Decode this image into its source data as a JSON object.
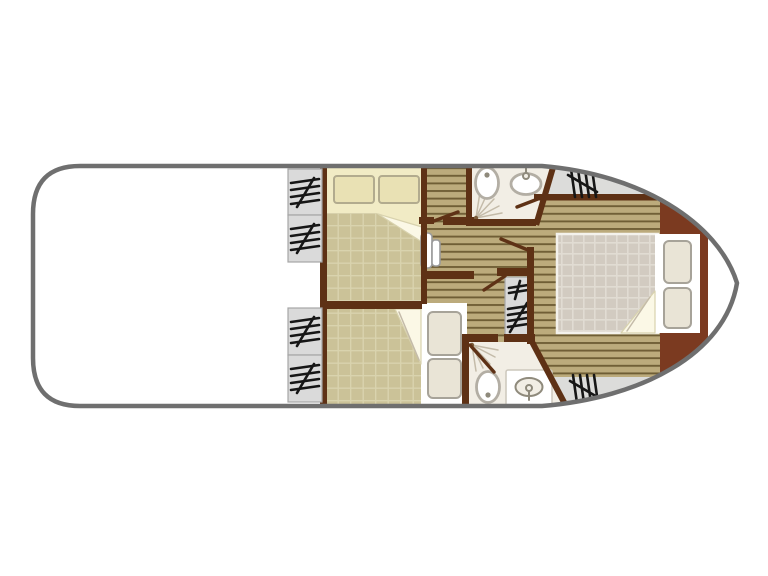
{
  "diagram": {
    "type": "boat-deck-plan",
    "description": "Top-down floor plan of a canal cruiser hull: open rounded aft deck on the left, two guest cabins with berths amidships, two shower rooms with WC and washbasin, a central companionway with steps, and a bow double-berth cabin; bow points to the right.",
    "orientation": "bow-right"
  },
  "rooms": [
    {
      "name": "aft-deck",
      "kind": "open deck",
      "furniture": []
    },
    {
      "name": "guest-cabin-port",
      "kind": "cabin",
      "furniture": [
        "double berth",
        "two pillows",
        "folded blanket"
      ]
    },
    {
      "name": "guest-cabin-starboard",
      "kind": "cabin",
      "furniture": [
        "berth",
        "two pillows",
        "folded blanket"
      ]
    },
    {
      "name": "shower-room-port",
      "kind": "bathroom",
      "furniture": [
        "toilet",
        "washbasin with tap",
        "corner shower spray"
      ]
    },
    {
      "name": "shower-room-starboard",
      "kind": "bathroom",
      "furniture": [
        "toilet",
        "washbasin counter with tap",
        "corner shower spray"
      ]
    },
    {
      "name": "companionway",
      "kind": "corridor",
      "furniture": [
        "steps",
        "fold-down seat"
      ]
    },
    {
      "name": "master-cabin-bow",
      "kind": "cabin",
      "furniture": [
        "double berth with quilted cover",
        "two pillows",
        "folded sheet",
        "hull-side locker"
      ]
    }
  ],
  "symbols": {
    "stair_marks": [
      {
        "location": "aft bulkhead upper",
        "count": 2
      },
      {
        "location": "aft bulkhead lower",
        "count": 2
      },
      {
        "location": "companionway",
        "count": 2
      },
      {
        "location": "bow side deck upper",
        "count": 1
      },
      {
        "location": "bow side deck lower",
        "count": 1
      }
    ]
  },
  "colors": {
    "hull-stroke": "#6f6f6f",
    "hull-fill": "#ffffff",
    "wall": "#5e3115",
    "band": "#7b3a20",
    "planks-bg": "#bcab7c",
    "planks-line": "#6f5e35",
    "grid-bg": "#cbc298",
    "grid-line": "#d9d3ae",
    "quilt-bg": "#d2cbc1",
    "quilt-line": "#e1dcd3",
    "quilt-border": "#f4f2ec",
    "bed-cream": "#f1ebc5",
    "pillow": "#e9e1b4",
    "pillow-border": "#b2ab8e",
    "pillow-alt": "#e9e4d6",
    "pillow-alt-border": "#a7a399",
    "fold": "#fbf8e6",
    "fold-line": "#d8d2ae",
    "deck-gray": "#dcdcda",
    "panel-gray": "#dadada",
    "panel-border": "#a6a6a6",
    "bath-floor": "#f2eee5",
    "fixture": "#b3aea4",
    "fixture-dark": "#8f8a7c",
    "spray": "#c4bba9",
    "step-border": "#9a9a9a"
  }
}
